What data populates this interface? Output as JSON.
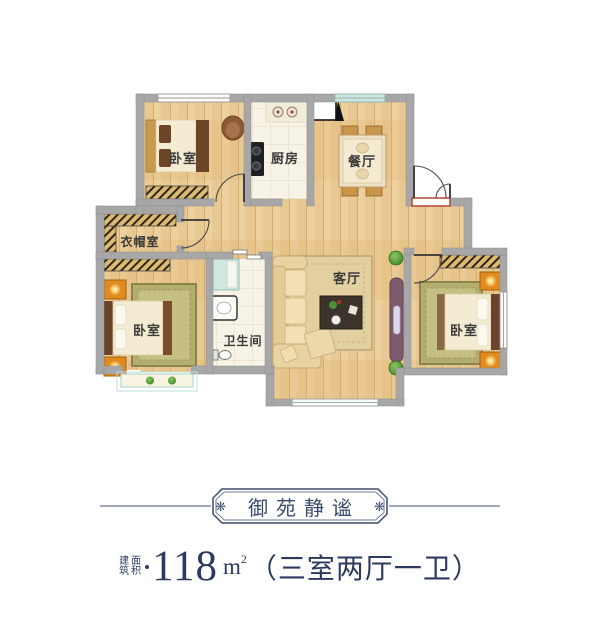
{
  "plan": {
    "rooms": [
      {
        "name": "bedroom-top-left",
        "label": "卧室"
      },
      {
        "name": "kitchen",
        "label": "厨房"
      },
      {
        "name": "dining-room",
        "label": "餐厅"
      },
      {
        "name": "cloakroom",
        "label": "衣帽室"
      },
      {
        "name": "bedroom-left",
        "label": "卧室"
      },
      {
        "name": "bathroom",
        "label": "卫生间"
      },
      {
        "name": "living-room",
        "label": "客厅"
      },
      {
        "name": "bedroom-right",
        "label": "卧室"
      }
    ]
  },
  "footer": {
    "title": "御苑静谧",
    "ornament": "❋",
    "area_label_col1": "建筑",
    "area_label_col2": "面积",
    "area_value": "118",
    "area_unit_base": "m",
    "area_unit_sup": "2",
    "area_spec": "（三室两厅一卫）"
  },
  "colors": {
    "accent_navy": "#3a4a6e",
    "wall_gray": "#a7a7a7",
    "wood_floor": "#e9c993",
    "tile": "#f7f3e6",
    "threshold_red": "#b23b30",
    "closet_hatch": "#ddba72",
    "lamp_orange": "#e08a1f"
  }
}
